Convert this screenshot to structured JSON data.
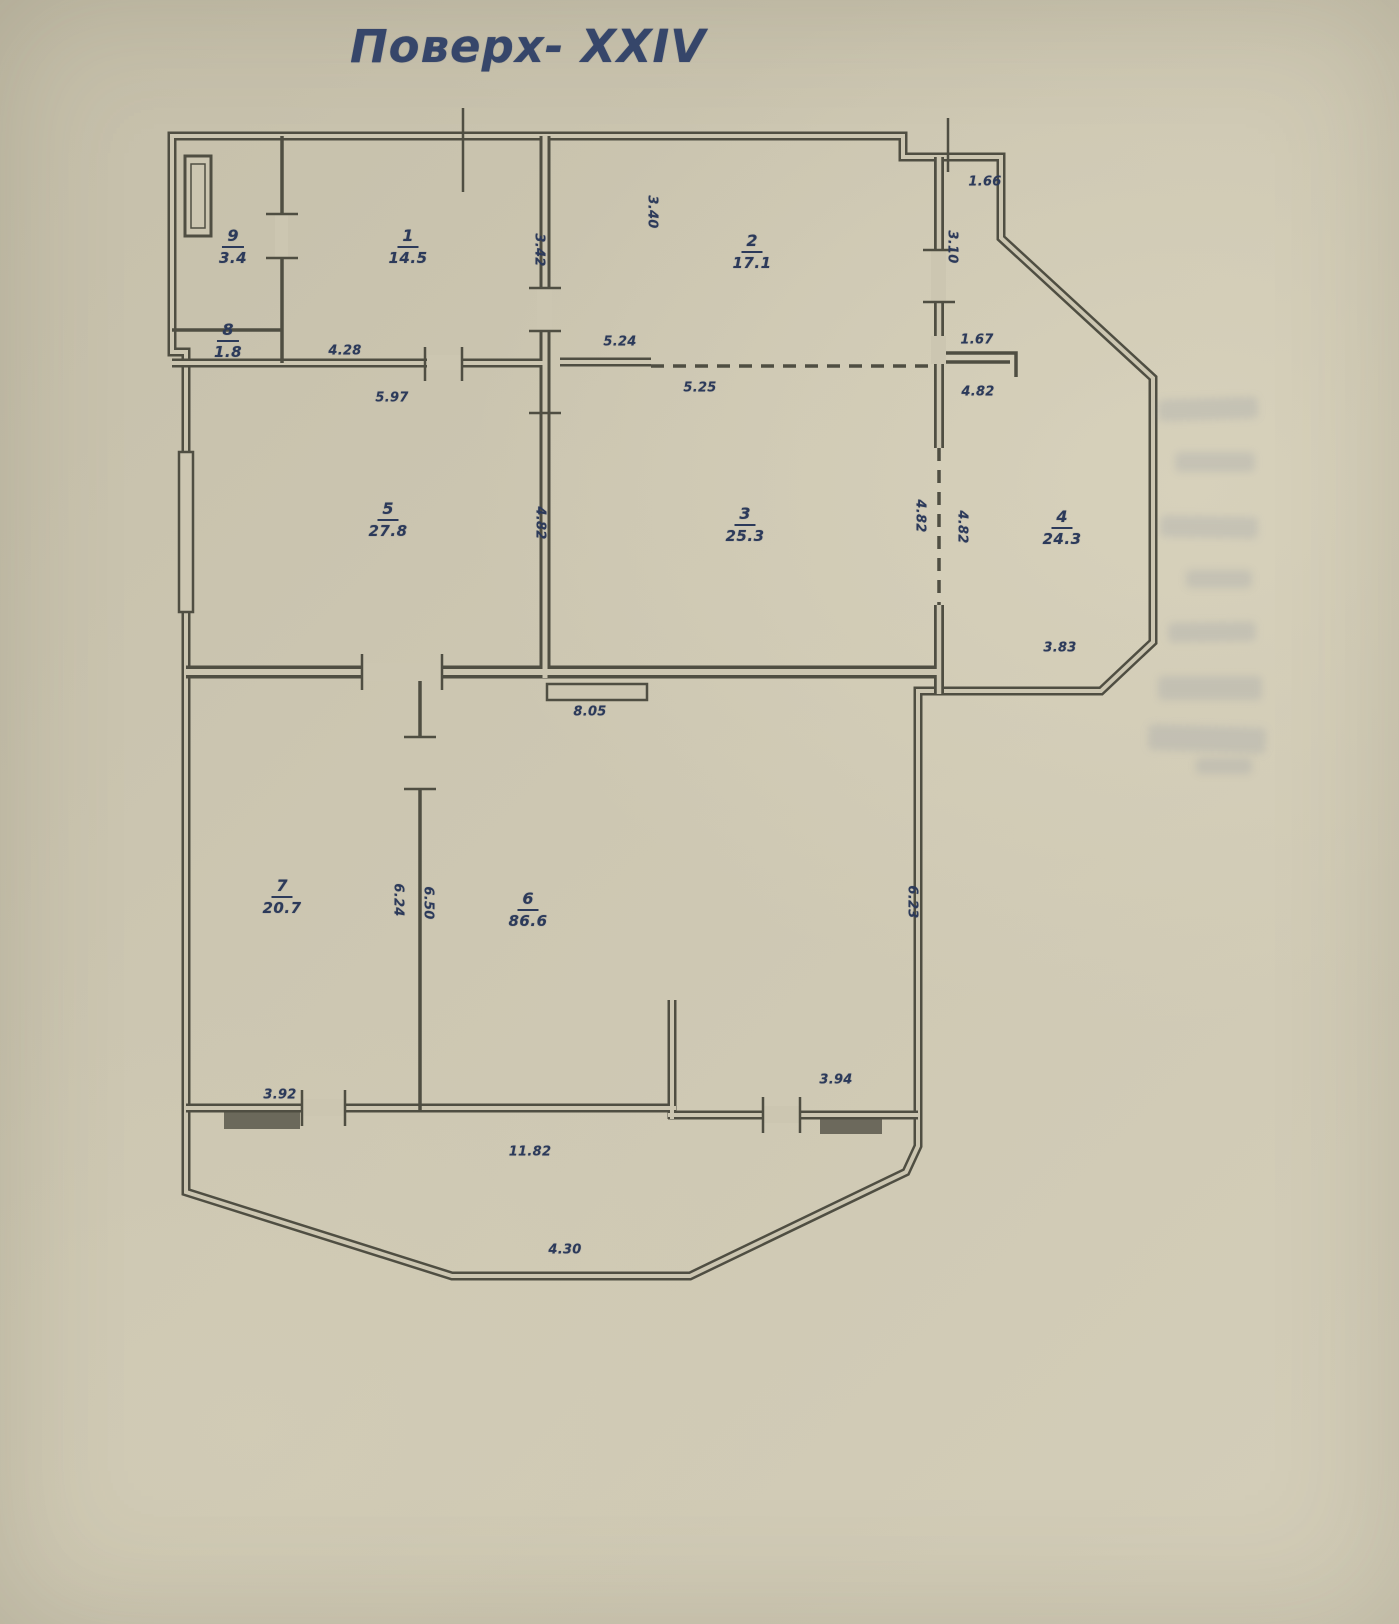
{
  "title": "Поверх- XXIV",
  "plan": {
    "colors": {
      "paper": "#ccc6b1",
      "wall": "#4f4e42",
      "ink": "#2c3a5a",
      "title": "#36466a"
    },
    "rooms": [
      {
        "number": "9",
        "area": "3.4",
        "x": 233,
        "y": 247
      },
      {
        "number": "8",
        "area": "1.8",
        "x": 228,
        "y": 341
      },
      {
        "number": "1",
        "area": "14.5",
        "x": 408,
        "y": 247
      },
      {
        "number": "2",
        "area": "17.1",
        "x": 752,
        "y": 252
      },
      {
        "number": "5",
        "area": "27.8",
        "x": 388,
        "y": 520
      },
      {
        "number": "3",
        "area": "25.3",
        "x": 745,
        "y": 525
      },
      {
        "number": "4",
        "area": "24.3",
        "x": 1062,
        "y": 528
      },
      {
        "number": "7",
        "area": "20.7",
        "x": 282,
        "y": 897
      },
      {
        "number": "6",
        "area": "86.6",
        "x": 528,
        "y": 910
      }
    ],
    "dimensions": [
      {
        "text": "1.66",
        "x": 985,
        "y": 182,
        "vertical": false
      },
      {
        "text": "3.40",
        "x": 652,
        "y": 212,
        "vertical": true
      },
      {
        "text": "3.42",
        "x": 539,
        "y": 250,
        "vertical": true
      },
      {
        "text": "3.10",
        "x": 952,
        "y": 247,
        "vertical": true
      },
      {
        "text": "5.24",
        "x": 620,
        "y": 342,
        "vertical": false
      },
      {
        "text": "1.67",
        "x": 977,
        "y": 340,
        "vertical": false
      },
      {
        "text": "4.28",
        "x": 345,
        "y": 351,
        "vertical": false
      },
      {
        "text": "5.97",
        "x": 392,
        "y": 398,
        "vertical": false
      },
      {
        "text": "5.25",
        "x": 700,
        "y": 388,
        "vertical": false
      },
      {
        "text": "4.82",
        "x": 978,
        "y": 392,
        "vertical": false
      },
      {
        "text": "4.82",
        "x": 540,
        "y": 523,
        "vertical": true
      },
      {
        "text": "4.82",
        "x": 920,
        "y": 516,
        "vertical": true
      },
      {
        "text": "4.82",
        "x": 962,
        "y": 527,
        "vertical": true
      },
      {
        "text": "3.83",
        "x": 1060,
        "y": 648,
        "vertical": false
      },
      {
        "text": "8.05",
        "x": 590,
        "y": 712,
        "vertical": false
      },
      {
        "text": "6.24",
        "x": 398,
        "y": 900,
        "vertical": true
      },
      {
        "text": "6.50",
        "x": 428,
        "y": 903,
        "vertical": true
      },
      {
        "text": "6.23",
        "x": 912,
        "y": 902,
        "vertical": true
      },
      {
        "text": "3.92",
        "x": 280,
        "y": 1095,
        "vertical": false
      },
      {
        "text": "3.94",
        "x": 836,
        "y": 1080,
        "vertical": false
      },
      {
        "text": "11.82",
        "x": 530,
        "y": 1152,
        "vertical": false
      },
      {
        "text": "4.30",
        "x": 565,
        "y": 1250,
        "vertical": false
      }
    ]
  }
}
